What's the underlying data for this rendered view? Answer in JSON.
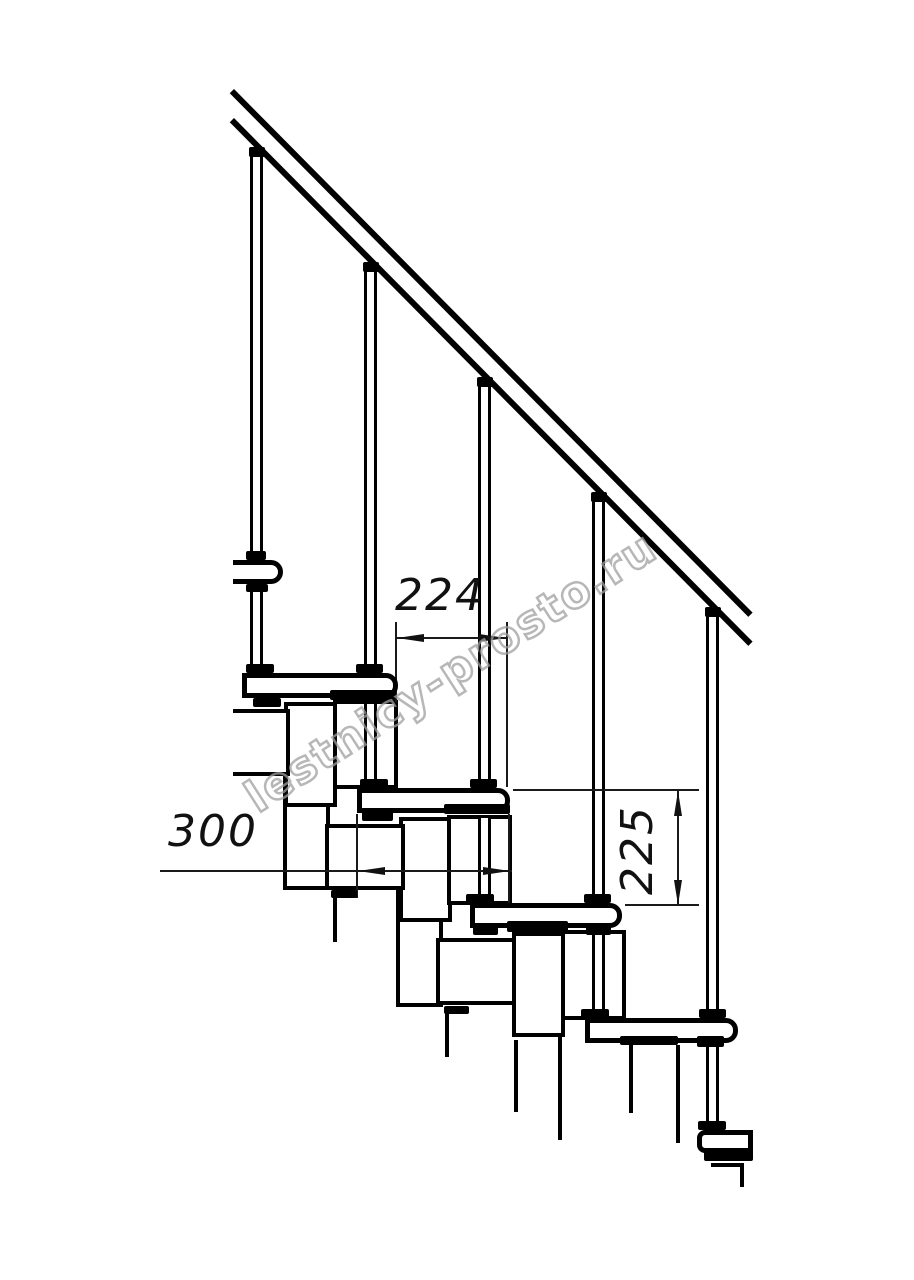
{
  "drawing": {
    "dimensions": {
      "step_run": "224",
      "tread_depth": "300",
      "riser_height": "225"
    },
    "watermark": {
      "text": "lestnicy-prosto.ru",
      "color": "#a0a0a0"
    },
    "colors": {
      "line": "#000000",
      "background": "#ffffff",
      "dimension_line": "#1a1a1a"
    }
  }
}
